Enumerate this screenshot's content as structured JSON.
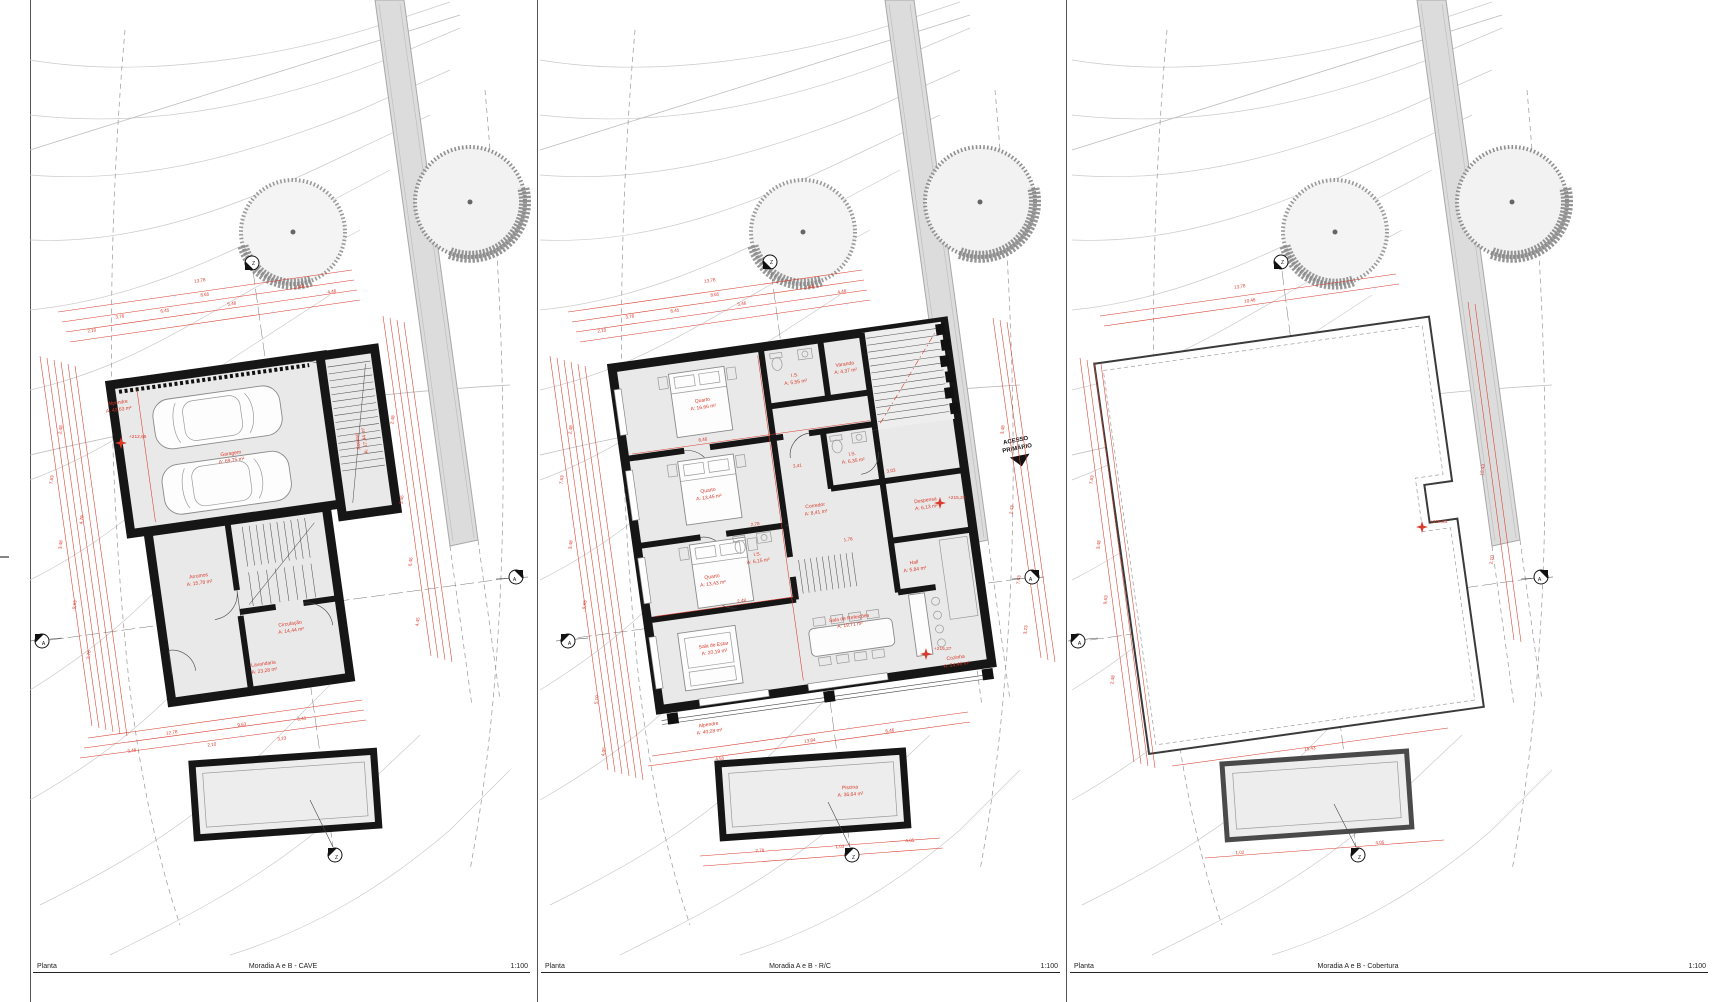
{
  "colors": {
    "dimension_red": "#d93a2b",
    "wall_black": "#161616",
    "floor_gray": "#e9e9e9",
    "contour_gray": "#cbcbcb",
    "road_gray": "#dcdcdc"
  },
  "footers": {
    "cave": {
      "type": "Planta",
      "title": "Moradia A e B - CAVE",
      "scale": "1:100"
    },
    "rc": {
      "type": "Planta",
      "title": "Moradia A e B - R/C",
      "scale": "1:100"
    },
    "cobertura": {
      "type": "Planta",
      "title": "Moradia A e B - Cobertura",
      "scale": "1:100"
    }
  },
  "cave": {
    "level": "+212,65",
    "rooms": {
      "alpendre": {
        "name": "Alpendre",
        "area": "A: 43,63 m²"
      },
      "garagem": {
        "name": "Garagem",
        "area": "A: 69,75 m²"
      },
      "acesso": {
        "name": "Acesso",
        "area": "A: 17,44 m²"
      },
      "arrumos": {
        "name": "Arrumos",
        "area": "A: 15,78 m²"
      },
      "circulacao": {
        "name": "Circulação",
        "area": "A: 14,44 m²"
      },
      "lavandaria": {
        "name": "Lavandaria",
        "area": "A: 23,28 m²"
      }
    }
  },
  "rc": {
    "levels": {
      "entry": "+215,20",
      "living": "+215,27"
    },
    "annotation": {
      "line1": "ACESSO",
      "line2": "PRIMÁRIO"
    },
    "rooms": {
      "quarto1": {
        "name": "Quarto",
        "area": "A: 16,66 m²"
      },
      "is1": {
        "name": "I.S.",
        "area": "A: 5,55 m²"
      },
      "varanda": {
        "name": "Varanda",
        "area": "A: 4,37 m²"
      },
      "quarto2": {
        "name": "Quarto",
        "area": "A: 13,45 m²"
      },
      "is2": {
        "name": "I.S.",
        "area": "A: 6,15 m²"
      },
      "is3": {
        "name": "I.S.",
        "area": "A: 6,35 m²"
      },
      "quarto3": {
        "name": "Quarto",
        "area": "A: 13,43 m²"
      },
      "corredor": {
        "name": "Corredor",
        "area": "A: 8,41 m²"
      },
      "hall": {
        "name": "Hall",
        "area": "A: 5,84 m²"
      },
      "despensa": {
        "name": "Despensa",
        "area": "A: 6,13 m²"
      },
      "cozinha": {
        "name": "Cozinha",
        "area": "A: 24,46 m²"
      },
      "sala_estar": {
        "name": "Sala de Estar",
        "area": "A: 20,19 m²"
      },
      "sala_refeicoes": {
        "name": "Sala de Refeições",
        "area": "A: 19,71 m²"
      },
      "alpendre": {
        "name": "Alpendre",
        "area": "A: 40,28 m²"
      },
      "piscina": {
        "name": "Piscina",
        "area": "A: 36,64 m²"
      }
    }
  },
  "cobertura": {
    "level": "+218,23"
  },
  "markers": {
    "section_horizontal": "A",
    "section_vertical": "Z"
  },
  "dims": {
    "cave_top": [
      "13,78",
      "8,65",
      "3,76",
      "6,45",
      "2,10",
      "5,46",
      "1,46",
      "4,48"
    ],
    "cave_left": [
      "7,63",
      "3,48",
      "2,48",
      "9,63",
      "4,78",
      "2,76"
    ],
    "cave_right": [
      "2,48",
      "5,46",
      "6,46",
      "4,45"
    ],
    "cave_bottom": [
      "12,78",
      "9,63",
      "6,45",
      "3,48",
      "2,10",
      "3,23"
    ],
    "rc_top": [
      "13,78",
      "8,65",
      "3,76",
      "6,45",
      "2,10",
      "5,46",
      "1,46",
      "4,48"
    ],
    "rc_left": [
      "7,63",
      "3,48",
      "9,63",
      "2,48",
      "5,10",
      "4,05"
    ],
    "rc_right": [
      "3,48",
      "2,43",
      "7,63",
      "3,23"
    ],
    "rc_bottom": [
      "13,84",
      "4,55",
      "6,46",
      "2,78",
      "1,03",
      "4,05"
    ],
    "rc_inner": [
      "8,46",
      "3,41",
      "2,78",
      "1,76",
      "3,03",
      "2,48"
    ],
    "cob_top": [
      "13,78",
      "10,46"
    ],
    "cob_left": [
      "7,63",
      "9,63",
      "3,48",
      "2,48"
    ],
    "cob_right": [
      "15,43",
      "2,10"
    ],
    "cob_bottom": [
      "15,43",
      "1,02",
      "4,05"
    ]
  }
}
